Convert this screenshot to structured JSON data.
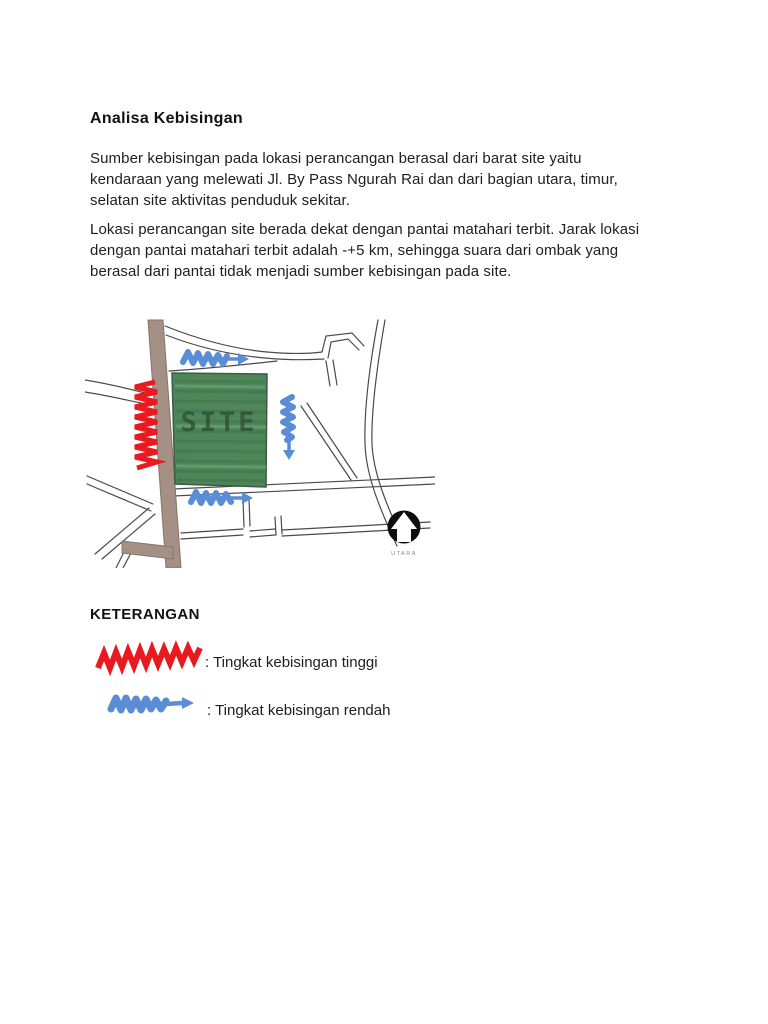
{
  "doc": {
    "title": "Analisa Kebisingan",
    "paragraphs": [
      {
        "lines": [
          "Sumber kebisingan pada lokasi perancangan berasal dari barat site yaitu",
          "kendaraan yang melewati Jl. By Pass Ngurah Rai dan dari bagian utara, timur,",
          "selatan site aktivitas penduduk sekitar."
        ]
      },
      {
        "lines": [
          "Lokasi perancangan site berada dekat dengan pantai matahari terbit. Jarak lokasi",
          "dengan pantai matahari terbit adalah -+5 km, sehingga suara dari ombak yang",
          "berasal dari pantai tidak menjadi sumber kebisingan pada site."
        ]
      }
    ]
  },
  "map": {
    "site_label": "SITE",
    "north_label": "UTARA",
    "colors": {
      "high_noise_red": "#e8191f",
      "low_noise_blue": "#5b8dd6",
      "site_green": "#4e8659",
      "road_brown": "#a59086",
      "thin_road_line": "#444444"
    }
  },
  "legend": {
    "heading": "KETERANGAN",
    "items": [
      {
        "symbol": "red-zigzag",
        "label": ": Tingkat kebisingan tinggi"
      },
      {
        "symbol": "blue-zigzag-arrow",
        "label": ": Tingkat kebisingan rendah"
      }
    ]
  }
}
